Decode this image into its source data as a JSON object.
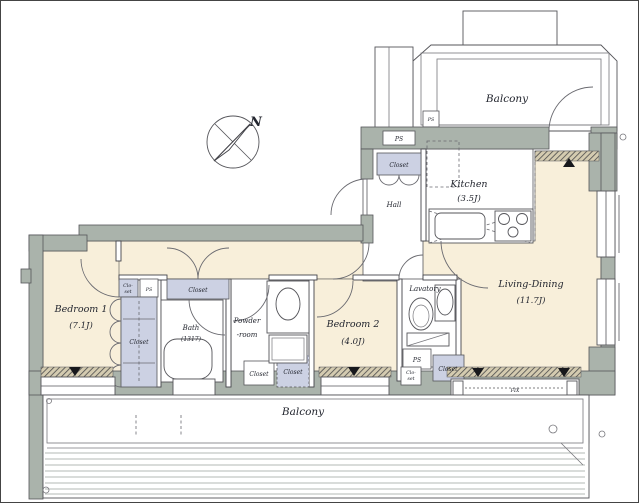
{
  "plan": {
    "compass_label": "N",
    "rooms": {
      "balcony_top": "Balcony",
      "kitchen_name": "Kitchen",
      "kitchen_size": "(3.5J)",
      "hall": "Hall",
      "living_dining_name": "Living-Dining",
      "living_dining_size": "(11.7J)",
      "bedroom1_name": "Bedroom 1",
      "bedroom1_size": "(7.1J)",
      "bath_name": "Bath",
      "bath_size": "(1317)",
      "powder_line1": "Powder",
      "powder_line2": "-room",
      "bedroom2_name": "Bedroom 2",
      "bedroom2_size": "(4.0J)",
      "lavatory": "Lavatory",
      "balcony_bottom": "Balcony"
    },
    "labels": {
      "closet": "Closet",
      "ps": "PS",
      "clo": "Clo-",
      "set": "set",
      "fix": "FIX"
    },
    "colors": {
      "floor_cream": "#f8efda",
      "wall_gray": "#aab3ab",
      "closet_lavender": "#ccd1e3",
      "line_dark": "#44444a",
      "marker_black": "#17181c"
    }
  }
}
